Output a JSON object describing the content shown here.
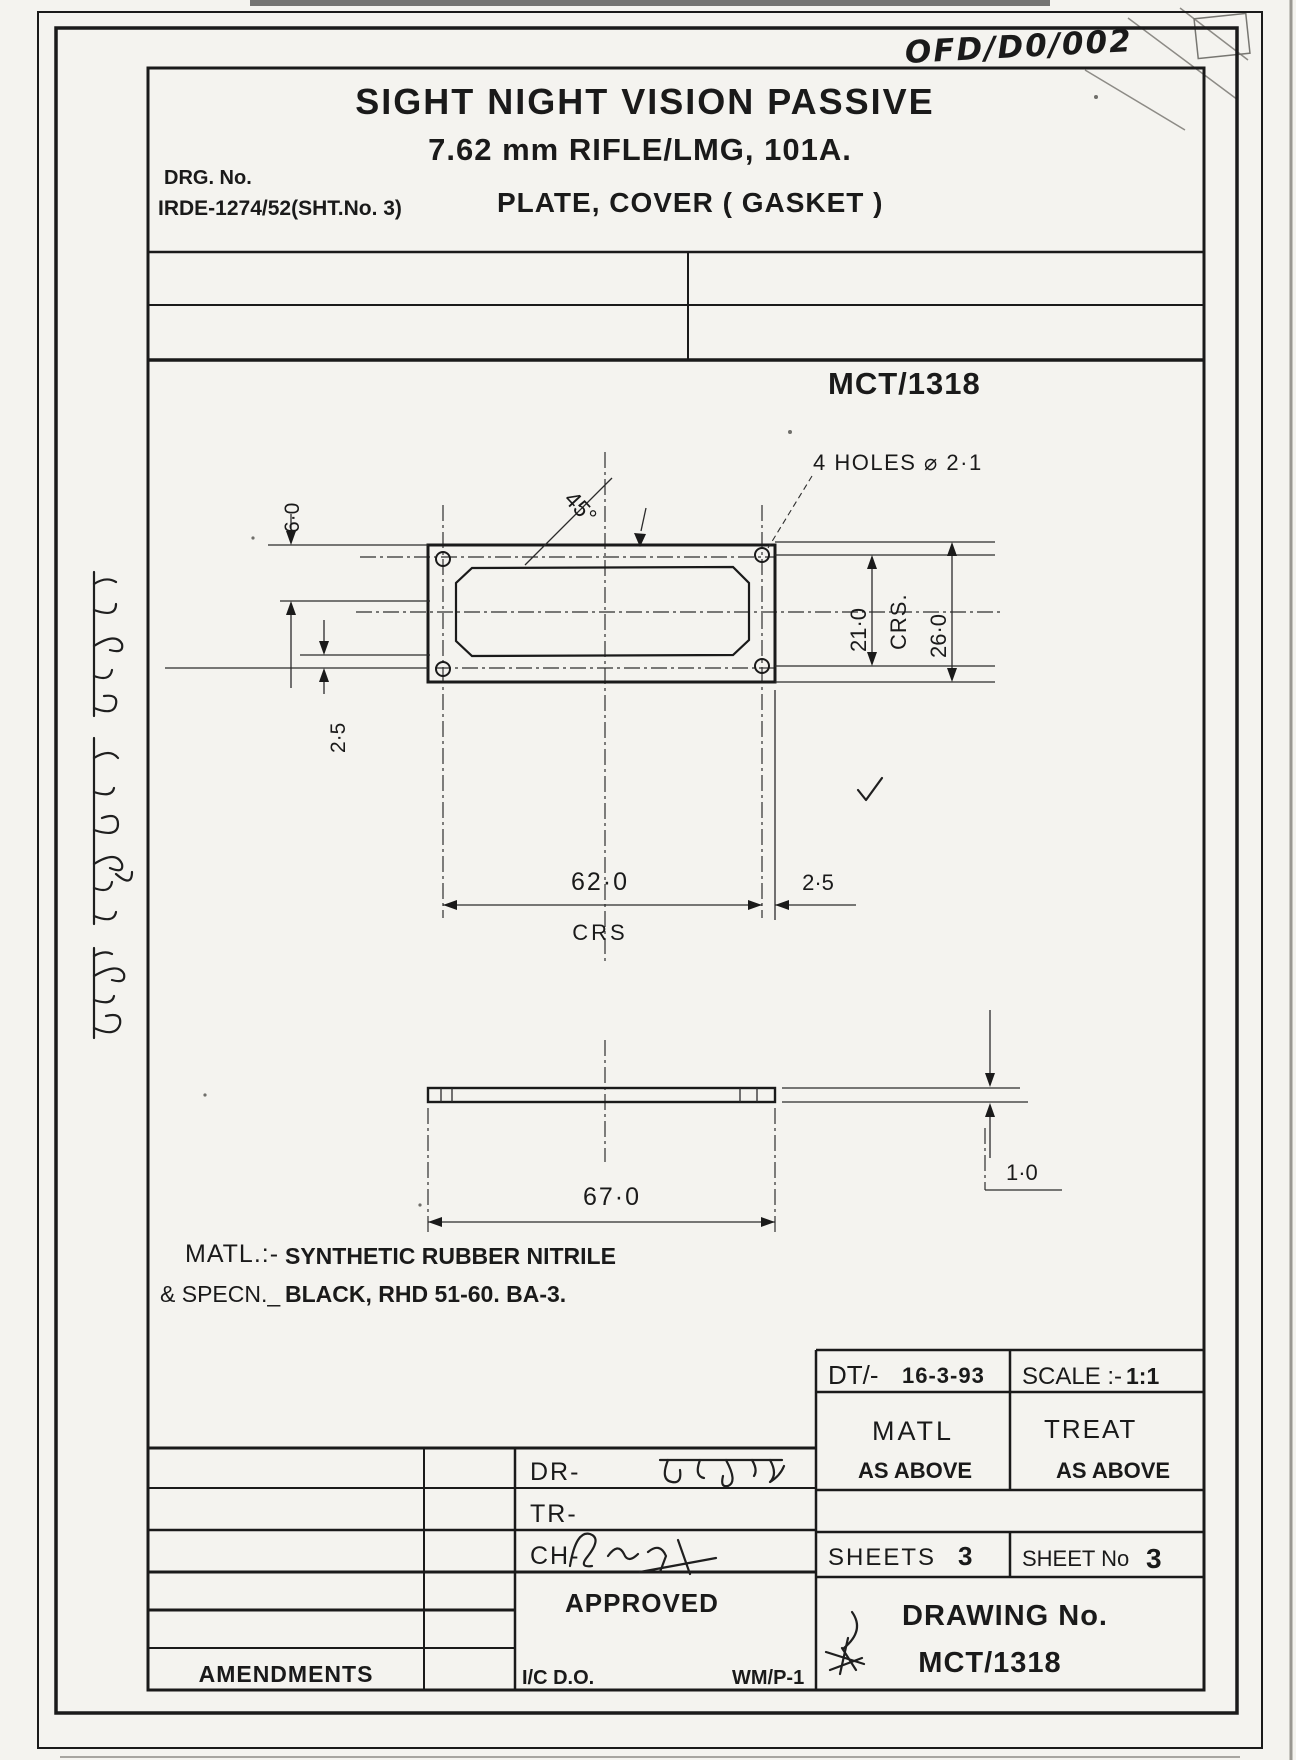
{
  "stamp": {
    "code": "OFD/D0/002"
  },
  "header": {
    "title_line1": "SIGHT NIGHT VISION PASSIVE",
    "title_line2": "7.62 mm RIFLE/LMG, 101A.",
    "drg_label": "DRG. No.",
    "drg_no": "IRDE-1274/52(SHT.No. 3)",
    "part_title": "PLATE, COVER ( GASKET )"
  },
  "drawing_ref": "MCT/1318",
  "annotations": {
    "holes_note": "4 HOLES ⌀ 2·1",
    "chamfer_angle": "45°"
  },
  "dimensions": {
    "edge_top": "6·0",
    "edge_left": "2·5",
    "holes_vert": "21·0",
    "crs_vert": "CRS.",
    "height": "26·0",
    "holes_horiz": "62·0",
    "crs_horiz": "CRS",
    "edge_right": "2·5",
    "width": "67·0",
    "thickness": "1·0"
  },
  "material_note": {
    "line1_label": "MATL.:-",
    "line1_value": "SYNTHETIC RUBBER NITRILE",
    "line2_label": "& SPECN._",
    "line2_value": "BLACK, RHD 51-60. BA-3."
  },
  "margin_note": {
    "text": "आयुध निर्माणी देहरादून"
  },
  "title_block": {
    "dt_label": "DT/-",
    "dt_value": "16-3-93",
    "scale_label": "SCALE :-",
    "scale_value": "1:1",
    "matl_label": "MATL",
    "matl_value": "AS ABOVE",
    "treat_label": "TREAT",
    "treat_value": "AS ABOVE",
    "sheets_label": "SHEETS",
    "sheets_value": "3",
    "sheet_no_label": "SHEET No",
    "sheet_no_value": "3",
    "drawing_no_label": "DRAWING No.",
    "drawing_no_value": "MCT/1318",
    "dr_label": "DR-",
    "tr_label": "TR-",
    "ch_label": "CH-",
    "approved_label": "APPROVED",
    "ic_do_label": "I/C D.O.",
    "wm_label": "WM/P-1",
    "amendments_label": "AMENDMENTS"
  }
}
